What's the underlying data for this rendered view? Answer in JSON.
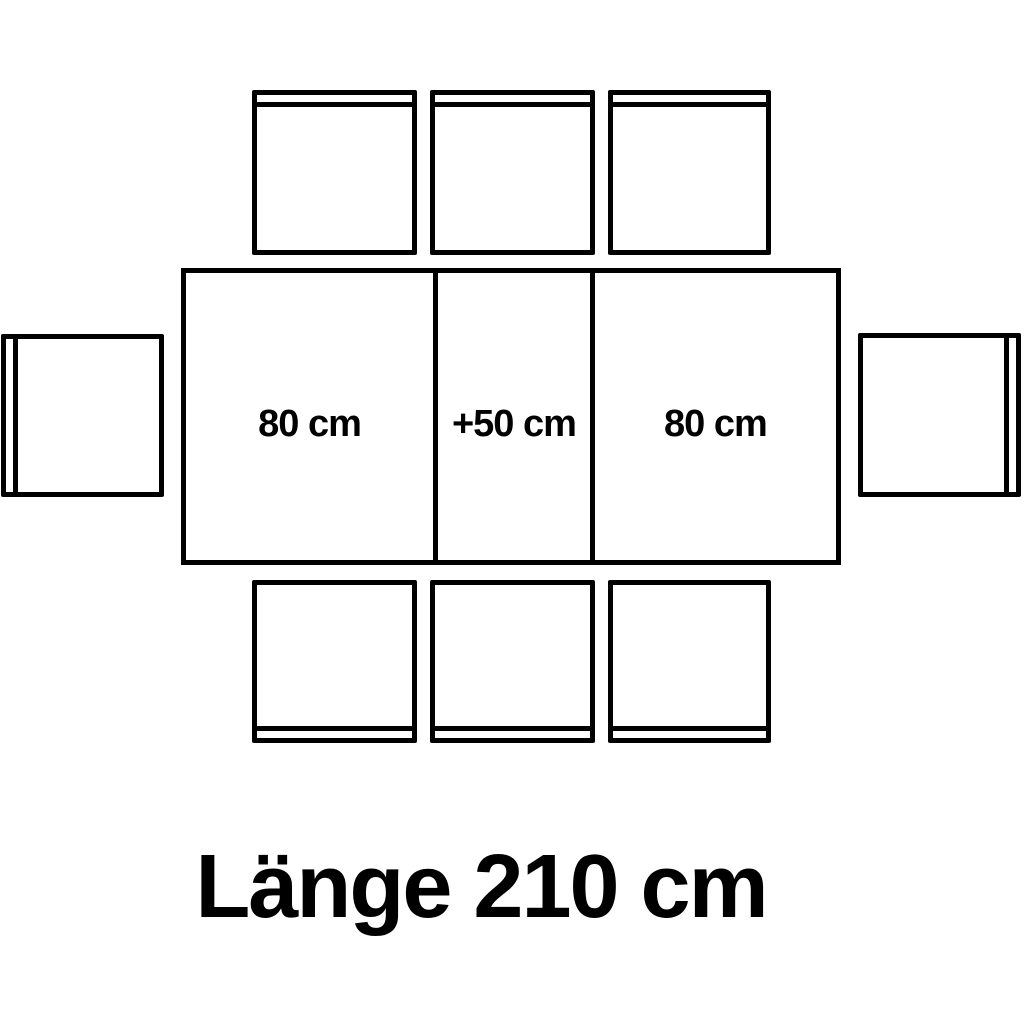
{
  "diagram": {
    "type": "table-dimension-top-view",
    "table": {
      "sections": [
        {
          "label": "80 cm"
        },
        {
          "label": "+50 cm"
        },
        {
          "label": "80 cm"
        }
      ],
      "caption": "Länge 210 cm"
    },
    "chairs": {
      "top_count": 3,
      "bottom_count": 3,
      "left_count": 1,
      "right_count": 1,
      "total": 8
    },
    "colors": {
      "line": "#000000",
      "background": "#ffffff",
      "text": "#000000"
    }
  }
}
